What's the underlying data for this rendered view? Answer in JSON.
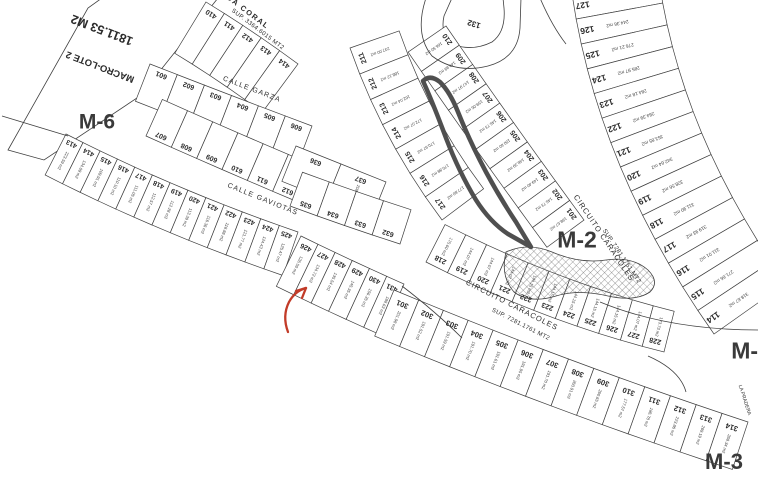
{
  "map": {
    "width": 758,
    "height": 484,
    "background": "#ffffff",
    "line_color": "#3f3f3f",
    "text_color": "#2b2b2b",
    "block_label_color": "#3a3a3a",
    "highlight_color": "#4f4f4f",
    "arrow_color": "#c23b28",
    "macro_lot": {
      "name": "MACRO-LOTE 2",
      "area": "1811.53 M2"
    },
    "shapes": [
      {
        "name": "macro-lote-2-parcel",
        "path": "M 8,150 L 88,8 L 102,-2 L 218,-2 L 140,96 L 44,160 Z"
      },
      {
        "name": "lot-132-parcel",
        "path": "M 452,-2 L 444,16 Q 440,34 452,44 Q 472,52 492,42 Q 506,32 504,8 L 503,-2 Z"
      }
    ],
    "extra_paths": [
      "M 426,-2 Q 414,34 432,56 Q 456,74 488,66 Q 518,58 520,28 L 521,-2",
      "M 540,-2 Q 552,26 566,44",
      "M 2,116 L 68,136",
      "M 402,286 Q 436,312 462,338",
      "M 600,302 Q 668,330 758,330",
      "M 648,356 Q 680,370 686,392"
    ],
    "highlight_path": "M 423,81 Q 433,103 446,138 Q 459,172 476,200 Q 490,222 508,234 L 531,247 L 516,222 Q 500,198 486,172 Q 470,142 458,112 Q 450,92 440,82 Q 430,74 423,81 Z",
    "hatch_path": "M 506,252 Q 528,242 552,252 Q 580,264 606,260 Q 632,256 648,270 Q 660,282 650,292 Q 635,302 608,296 Q 578,289 556,296 Q 530,304 514,292 Q 500,276 506,252 Z",
    "arrow": {
      "path": "M 288,332 Q 282,316 289,302 Q 295,291 306,288",
      "head1": "M 306,288 L 296,291",
      "head2": "M 306,288 L 302,298"
    },
    "labels": [
      {
        "t": "1811.53 M2",
        "x": 102,
        "y": 30,
        "rot": 201,
        "s": 12.5,
        "w": 600,
        "name": "macrolot-area-label"
      },
      {
        "t": "MACRO-LOTE 2",
        "x": 100,
        "y": 67,
        "rot": 201,
        "s": 9.5,
        "w": 600,
        "name": "macrolot-name-label"
      },
      {
        "t": "132",
        "x": 474,
        "y": 24,
        "rot": 197,
        "s": 8,
        "w": 600,
        "name": "lot-132-number"
      },
      {
        "t": "DA CORAL",
        "x": 248,
        "y": 12,
        "rot": 37,
        "s": 7.5,
        "w": 600,
        "ls": 1.5,
        "name": "street-label-da-coral"
      },
      {
        "t": "SUP. 3364.6015 MT2",
        "x": 258,
        "y": 29,
        "rot": 37,
        "s": 6,
        "w": 400,
        "ls": 0.4,
        "name": "street-label-da-coral-sup"
      },
      {
        "t": "CALLE GARZA",
        "x": 252,
        "y": 89,
        "rot": 21,
        "s": 7,
        "w": 400,
        "ls": 1.2,
        "name": "street-label-calle-garza"
      },
      {
        "t": "CALLE GAVIOTAS",
        "x": 263,
        "y": 199,
        "rot": 22,
        "s": 7,
        "w": 400,
        "ls": 1.2,
        "name": "street-label-calle-gaviotas"
      },
      {
        "t": "CIRCUITO CARACOLES",
        "x": 604,
        "y": 238,
        "rot": 56,
        "s": 7.5,
        "w": 400,
        "ls": 1,
        "name": "street-label-circuito-caracoles-upper"
      },
      {
        "t": "SUP. 7281.1761 MT2",
        "x": 622,
        "y": 256,
        "rot": 56,
        "s": 6,
        "w": 400,
        "ls": 0.4,
        "name": "street-label-circuito-caracoles-upper-sup"
      },
      {
        "t": "CIRCUITO CARACOLES",
        "x": 512,
        "y": 305,
        "rot": 27,
        "s": 7.5,
        "w": 400,
        "ls": 1,
        "name": "street-label-circuito-caracoles-lower"
      },
      {
        "t": "SUP. 7281.1761 MT2",
        "x": 521,
        "y": 324,
        "rot": 27,
        "s": 6,
        "w": 400,
        "ls": 0.4,
        "name": "street-label-circuito-caracoles-lower-sup"
      },
      {
        "t": "LA PRADERA",
        "x": 745,
        "y": 400,
        "rot": 72,
        "s": 5,
        "w": 400,
        "name": "street-label-la-pradera"
      },
      {
        "t": "M-6",
        "x": 97,
        "y": 122,
        "rot": 0,
        "s": 21,
        "w": 700,
        "name": "block-label-m6"
      },
      {
        "t": "M-2",
        "x": 577,
        "y": 240,
        "rot": 0,
        "s": 23,
        "w": 700,
        "name": "block-label-m2"
      },
      {
        "t": "M-1",
        "x": 751,
        "y": 351,
        "rot": 0,
        "s": 23,
        "w": 700,
        "name": "block-label-m1"
      },
      {
        "t": "M-3",
        "x": 724,
        "y": 462,
        "rot": 0,
        "s": 22,
        "w": 700,
        "name": "block-label-m3"
      }
    ],
    "strips": [
      {
        "name": "row-410-414",
        "p0": [
          206,
          2
        ],
        "c": [
          252,
          30
        ],
        "p1": [
          298,
          64
        ],
        "depth": 60,
        "side": 1,
        "flip": true,
        "numInset": 0.13,
        "areaInset": 0.52,
        "numSize": 7,
        "lots": [
          {
            "n": "410"
          },
          {
            "n": "411"
          },
          {
            "n": "412"
          },
          {
            "n": "413"
          },
          {
            "n": "414"
          }
        ]
      },
      {
        "name": "row-601-606",
        "p0": [
          150,
          64
        ],
        "c": [
          232,
          96
        ],
        "p1": [
          312,
          126
        ],
        "depth": 40,
        "side": 1,
        "flip": true,
        "numInset": 0.16,
        "numSize": 7,
        "lots": [
          {
            "n": "601"
          },
          {
            "n": "602"
          },
          {
            "n": "603"
          },
          {
            "n": "604"
          },
          {
            "n": "605"
          },
          {
            "n": "606"
          }
        ]
      },
      {
        "name": "row-607-612",
        "p0": [
          146,
          136
        ],
        "c": [
          222,
          170
        ],
        "p1": [
          298,
          202
        ],
        "depth": 40,
        "side": -1,
        "flip": true,
        "numInset": 0.15,
        "numSize": 7,
        "lots": [
          {
            "n": "607"
          },
          {
            "n": "608"
          },
          {
            "n": "609"
          },
          {
            "n": "610"
          },
          {
            "n": "611"
          },
          {
            "n": "612"
          }
        ]
      },
      {
        "name": "row-413-425",
        "p0": [
          66,
          134
        ],
        "c": [
          176,
          190
        ],
        "p1": [
          298,
          232
        ],
        "depth": 46,
        "side": 1,
        "flip": true,
        "numInset": 0.14,
        "areaInset": 0.55,
        "numSize": 6.8,
        "lots": [
          {
            "n": "413",
            "a": "223.59 m2"
          },
          {
            "n": "414",
            "a": "134.09 m2"
          },
          {
            "n": "415",
            "a": "109.91 m2"
          },
          {
            "n": "416",
            "a": "110.10 m2"
          },
          {
            "n": "417",
            "a": "111.05 m2"
          },
          {
            "n": "418",
            "a": "112.57 m2"
          },
          {
            "n": "419",
            "a": "112.28 m2"
          },
          {
            "n": "420",
            "a": "113.39 m2"
          },
          {
            "n": "421",
            "a": "116.36 m2"
          },
          {
            "n": "422",
            "a": "118.88 m2"
          },
          {
            "n": "423",
            "a": "121.77 m2"
          },
          {
            "n": "424",
            "a": "124.43 m2"
          },
          {
            "n": "425",
            "a": "125.47 m2"
          }
        ]
      },
      {
        "name": "row-426-431",
        "p0": [
          301,
          236
        ],
        "c": [
          352,
          261
        ],
        "p1": [
          404,
          284
        ],
        "depth": 56,
        "side": 1,
        "flip": true,
        "numInset": 0.15,
        "areaInset": 0.5,
        "numSize": 7,
        "lots": [
          {
            "n": "426",
            "a": "126.50 m2"
          },
          {
            "n": "427",
            "a": "134.72 m2"
          },
          {
            "n": "428",
            "a": "135.54 m2"
          },
          {
            "n": "429",
            "a": "145.35 m2"
          },
          {
            "n": "430",
            "a": "156.35 m2"
          },
          {
            "n": "431",
            "a": "188.63 m2"
          }
        ]
      },
      {
        "name": "row-636-637",
        "p0": [
          296,
          146
        ],
        "c": [
          341,
          164
        ],
        "p1": [
          386,
          182
        ],
        "depth": 38,
        "side": 1,
        "flip": true,
        "numInset": 0.2,
        "areaInset": 0.6,
        "numSize": 7,
        "lots": [
          {
            "n": "636"
          },
          {
            "n": "637",
            "a": "208.22 m2"
          }
        ]
      },
      {
        "name": "row-632-635",
        "p0": [
          290,
          206
        ],
        "c": [
          344,
          226
        ],
        "p1": [
          400,
          244
        ],
        "depth": 36,
        "side": -1,
        "flip": true,
        "numInset": 0.18,
        "numSize": 7,
        "lots": [
          {
            "n": "635"
          },
          {
            "n": "634"
          },
          {
            "n": "633"
          },
          {
            "n": "632"
          }
        ]
      },
      {
        "name": "col-211-217",
        "p0": [
          350,
          48
        ],
        "c": [
          382,
          140
        ],
        "p1": [
          442,
          220
        ],
        "depth": 52,
        "side": -1,
        "flip": true,
        "numInset": 0.16,
        "areaInset": 0.52,
        "numSize": 7.2,
        "lots": [
          {
            "n": "211",
            "a": "237.00 m2"
          },
          {
            "n": "212",
            "a": "188.12 m2"
          },
          {
            "n": "213",
            "a": "162.04 m2"
          },
          {
            "n": "214",
            "a": "172.07 m2"
          },
          {
            "n": "215",
            "a": "170.97 m2"
          },
          {
            "n": "216",
            "a": "170.88 m2"
          },
          {
            "n": "217",
            "a": "177.80 m2"
          }
        ]
      },
      {
        "name": "col-210-201",
        "p0": [
          446,
          26
        ],
        "c": [
          512,
          122
        ],
        "p1": [
          584,
          220
        ],
        "depth": 46,
        "side": 1,
        "flip": true,
        "numInset": 0.14,
        "areaInset": 0.5,
        "numSize": 7.2,
        "lots": [
          {
            "n": "210",
            "a": "166.50 m2"
          },
          {
            "n": "209",
            "a": "149.89 m2"
          },
          {
            "n": "208",
            "a": "147.97 m2"
          },
          {
            "n": "207",
            "a": "159.05 m2"
          },
          {
            "n": "206",
            "a": "146.73 m2"
          },
          {
            "n": "205",
            "a": "150.60 m2"
          },
          {
            "n": "204",
            "a": "148.39 m2"
          },
          {
            "n": "203",
            "a": "149.40 m2"
          },
          {
            "n": "202",
            "a": "146.73 m2"
          },
          {
            "n": "201",
            "a": "198.67 m2"
          }
        ]
      },
      {
        "name": "row-218-228",
        "p0": [
          426,
          262
        ],
        "c": [
          544,
          322
        ],
        "p1": [
          664,
          352
        ],
        "depth": 42,
        "side": -1,
        "flip": true,
        "numInset": 0.2,
        "areaInset": 0.55,
        "numSize": 7.2,
        "lots": [
          {
            "n": "218",
            "a": "175.60 m2"
          },
          {
            "n": "219",
            "a": "144.07 m2"
          },
          {
            "n": "220",
            "a": "144.07 m2"
          },
          {
            "n": "221",
            "a": "144.07 m2"
          },
          {
            "n": "222",
            "a": "144.15 m2"
          },
          {
            "n": "223",
            "a": "144.15 m2"
          },
          {
            "n": "224",
            "a": "144.15 m2"
          },
          {
            "n": "225",
            "a": "144.15 m2"
          },
          {
            "n": "226",
            "a": "144.15 m2"
          },
          {
            "n": "227",
            "a": "144.07 m2"
          },
          {
            "n": "228",
            "a": "173.73 m2"
          }
        ]
      },
      {
        "name": "row-301-314",
        "p0": [
          394,
          290
        ],
        "c": [
          566,
          362
        ],
        "p1": [
          748,
          422
        ],
        "depth": 50,
        "side": 1,
        "flip": true,
        "numInset": 0.2,
        "areaInset": 0.55,
        "numSize": 7.5,
        "lots": [
          {
            "n": "301",
            "a": "201.98 m2"
          },
          {
            "n": "302",
            "a": "191.52 m2"
          },
          {
            "n": "303",
            "a": "191.59 m2"
          },
          {
            "n": "304",
            "a": "191.70 m2"
          },
          {
            "n": "305",
            "a": "191.61 m2"
          },
          {
            "n": "306",
            "a": "191.95 m2"
          },
          {
            "n": "307",
            "a": "191.70 m2"
          },
          {
            "n": "308",
            "a": "260.91 m2"
          },
          {
            "n": "309",
            "a": "260.65 m2"
          },
          {
            "n": "310",
            "a": "177.57 m2"
          },
          {
            "n": "311",
            "a": "186.78 m2"
          },
          {
            "n": "312",
            "a": "223.86 m2"
          },
          {
            "n": "313",
            "a": "269.19 m2"
          },
          {
            "n": "314",
            "a": "268.34 m2"
          }
        ]
      },
      {
        "name": "col-114-127",
        "p0": [
          572,
          -6
        ],
        "c": [
          598,
          170
        ],
        "p1": [
          714,
          334
        ],
        "depth": 88,
        "side": -1,
        "flip": true,
        "numAlong": "depth",
        "numInset": 0.1,
        "areaInset": 0.45,
        "numSize": 8.5,
        "areaSize": 4.8,
        "lots": [
          {
            "n": "127"
          },
          {
            "n": "126",
            "a": "244.36 m2"
          },
          {
            "n": "125",
            "a": "276.21 m2"
          },
          {
            "n": "124",
            "a": "285.97 m2"
          },
          {
            "n": "123",
            "a": "284.18 m2"
          },
          {
            "n": "122",
            "a": "284.39 m2"
          },
          {
            "n": "121",
            "a": "353.85 m2"
          },
          {
            "n": "120",
            "a": "342.64 m2"
          },
          {
            "n": "119",
            "a": "328.56 m2"
          },
          {
            "n": "118",
            "a": "311.90 m2"
          },
          {
            "n": "117",
            "a": "319.93 m2"
          },
          {
            "n": "116",
            "a": "311.01 m2"
          },
          {
            "n": "115",
            "a": "271.66 m2"
          },
          {
            "n": "114",
            "a": "318.67 m2"
          }
        ]
      }
    ]
  }
}
